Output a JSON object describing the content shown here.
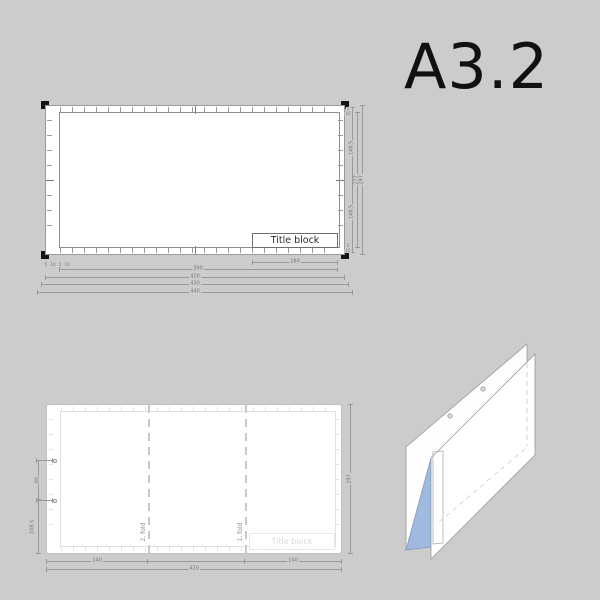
{
  "colors": {
    "background": "#cccccc",
    "sheet": "#ffffff",
    "line_gray": "#999999",
    "corner_black": "#141414",
    "fold_blue": "#a0b9e0"
  },
  "title": {
    "text": "A3.2"
  },
  "front_view": {
    "title_block": "Title block",
    "dims": {
      "half_height_top": "148.5",
      "half_height_bottom": "148.5",
      "inner_height": "277",
      "sheet_height": "297",
      "title_block_width": "180",
      "inner_width": "390",
      "sheet_width": "420",
      "trim_width": "430",
      "overall_width": "440",
      "margin_small_1": "5",
      "margin_small_2": "10",
      "margin_small_3": "5",
      "margin_small_4": "10",
      "corner_small_1": "5",
      "corner_small_2": "10"
    }
  },
  "fold_view": {
    "fold_line_1": "1. fold",
    "fold_line_2": "2. fold",
    "title_block": "Title block",
    "dims": {
      "hole_spacing": "80",
      "below_hole": "108.5",
      "left_panel": "140",
      "right_panel": "140",
      "sheet_width": "420",
      "sheet_height": "297"
    }
  }
}
